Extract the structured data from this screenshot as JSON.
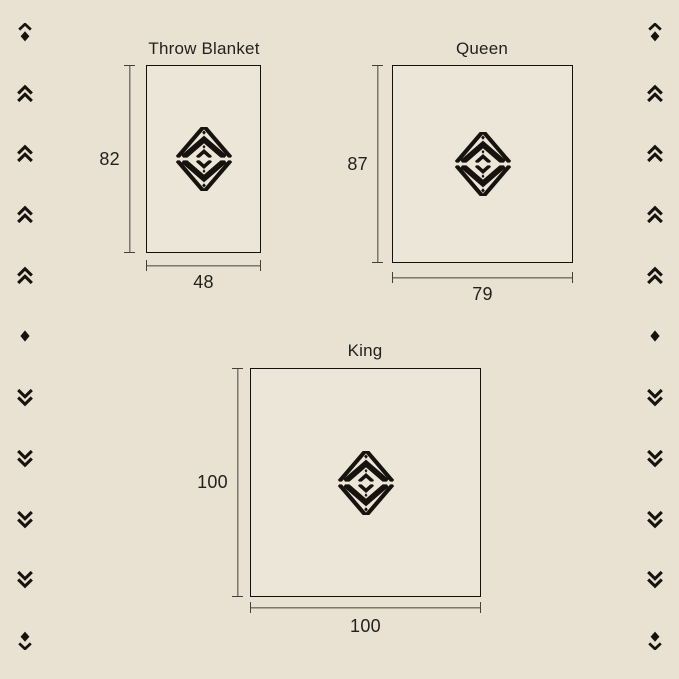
{
  "page": {
    "background_color": "#e9e2d3",
    "ink_color": "#16130f",
    "line_color": "#45403a",
    "text_color": "#24211d"
  },
  "diagrams": [
    {
      "title": "Throw Blanket",
      "height_label": "82",
      "width_label": "48"
    },
    {
      "title": "Queen",
      "height_label": "87",
      "width_label": "79"
    },
    {
      "title": "King",
      "height_label": "100",
      "width_label": "100"
    }
  ],
  "ornaments": {
    "left_sequence": [
      "chevron-up-diamond",
      "double-chevron-up",
      "double-chevron-up",
      "double-chevron-up",
      "double-chevron-up",
      "diamond",
      "double-chevron-down",
      "double-chevron-down",
      "double-chevron-down",
      "double-chevron-down",
      "diamond-chevron-down"
    ],
    "right_sequence": [
      "chevron-up-diamond",
      "double-chevron-up",
      "double-chevron-up",
      "double-chevron-up",
      "double-chevron-up",
      "diamond",
      "double-chevron-down",
      "double-chevron-down",
      "double-chevron-down",
      "double-chevron-down",
      "diamond-chevron-down"
    ]
  }
}
